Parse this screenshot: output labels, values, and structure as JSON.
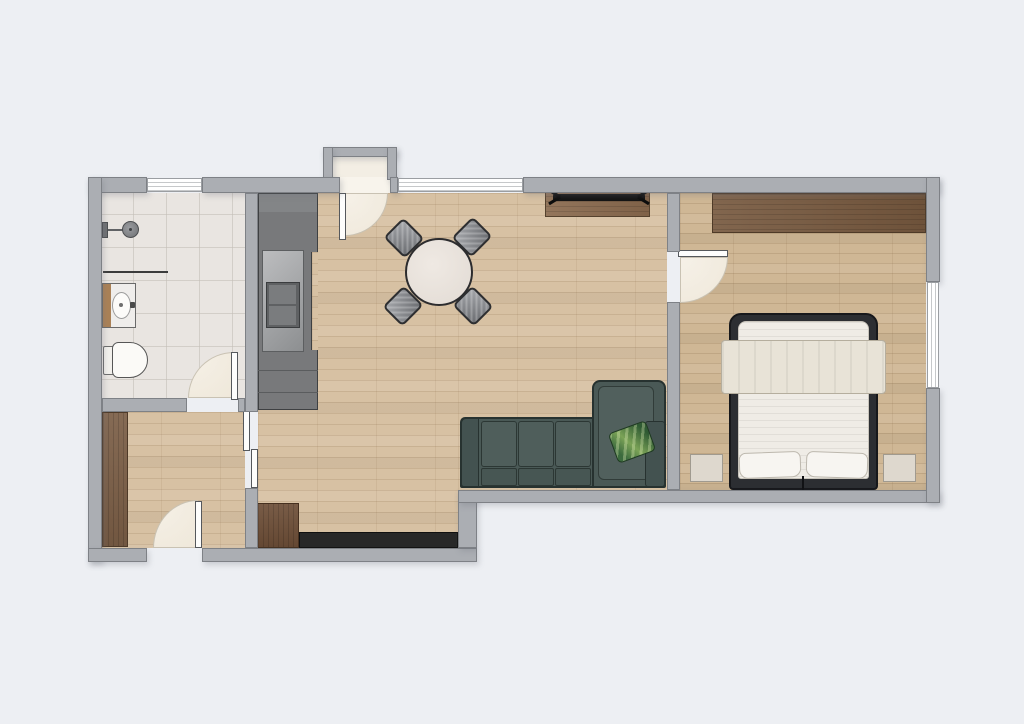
{
  "title": "Apartment floor plan (top-down 2D render, no text labels)",
  "plan": {
    "background_color": "#edeff3",
    "wall_color": "#abaeb3",
    "rooms": [
      {
        "name": "Bathroom",
        "floor": "ceramic tile",
        "fixtures": [
          "shower with wall shower head",
          "shower partition",
          "vanity sink with wood side panel",
          "toilet"
        ],
        "windows": 1,
        "doors": 1
      },
      {
        "name": "Hallway",
        "floor": "wood parquet",
        "furniture": [
          "tall wardrobe",
          "wood cabinet",
          "dark sideboard"
        ],
        "doors": [
          "apartment entry door (bottom wall)",
          "sliding door to living room"
        ]
      },
      {
        "name": "Living room with open kitchen",
        "floor": "wood parquet",
        "furniture": [
          "kitchen counter with double sink",
          "round dining table",
          "dining chair x4",
          "tv sideboard",
          "flat tv",
          "corner sofa with chaise",
          "leaf-pattern throw pillow"
        ],
        "windows": 1,
        "doors": [
          "entrance door with porch recess (top wall)"
        ]
      },
      {
        "name": "Bedroom",
        "floor": "wood parquet",
        "furniture": [
          "wide wardrobe along top wall",
          "double bed with blanket and two pillows",
          "nightstand x2"
        ],
        "windows": 1,
        "doors": 1
      }
    ],
    "opening_counts": {
      "windows": 3,
      "hinged_doors": 4,
      "sliding_doors": 1
    },
    "colors": {
      "floor_wood": "#d7c1a3",
      "floor_wood_bedroom": "#cfb795",
      "floor_tile": "#e9e5e1",
      "sofa_body": "#4a5956",
      "pillow_accent_green": "#5d8a4a",
      "bed_frame": "#2c2e32",
      "linen": "#efece6",
      "blanket": "#e8e3d7",
      "wood_furniture": "#7a5c42",
      "kitchen_counter": "#78797b",
      "dark_sideboard": "#282828",
      "door_swing_fill": "#f2ecdf"
    }
  }
}
